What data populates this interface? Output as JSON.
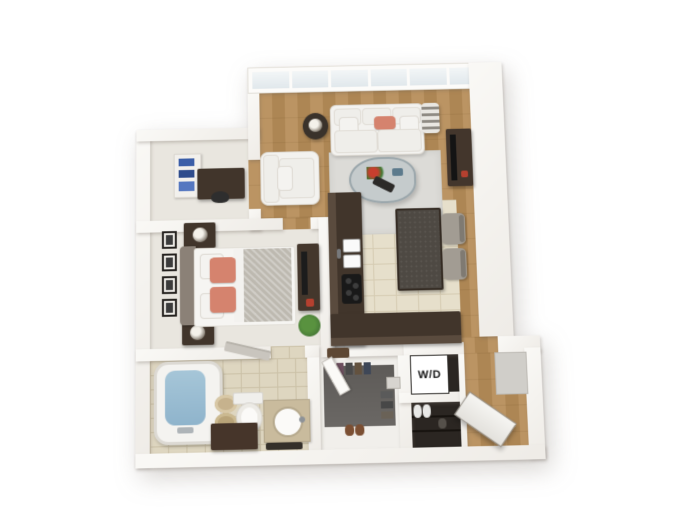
{
  "labels": {
    "washer_dryer": "W/D"
  },
  "palette": {
    "wall": "#faf9f6",
    "wood": "#bb9463",
    "wood-dark": "#ad8654",
    "tile": "#e6dfcb",
    "grout": "#d5cbb2",
    "bath-tile": "#ded6c0",
    "bath-grout": "#cbc1a7",
    "carpet": "#e9e6df",
    "rug": "#dcdbd7",
    "sofa-white": "#f3f2ef",
    "coral": "#d5836e",
    "counter": "#41352b",
    "island-top": "#4e4943",
    "gray-chair": "#a29c93",
    "water": "#8fb4cc",
    "plant": "#4a7c39",
    "closet-rug": "#6b6865",
    "dark-room": "#2b2622",
    "blanket": "#bdb9b0",
    "headboard": "#8b8177",
    "towel-tan": "#c6b28d",
    "vanity-tan": "#c9bb9d",
    "book-blue": "#3b5ea8"
  }
}
